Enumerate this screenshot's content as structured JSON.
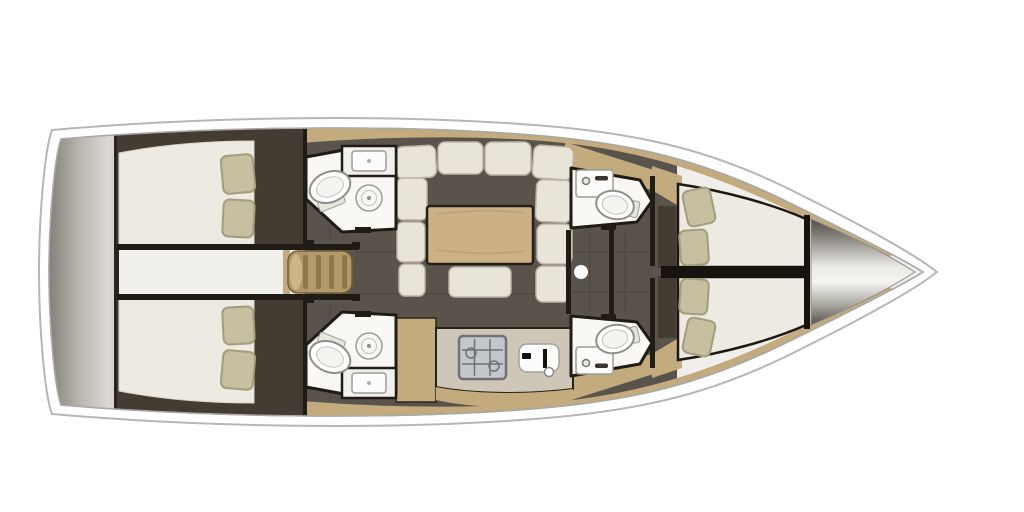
{
  "meta": {
    "title": "Sailing yacht interior layout — top-down floor plan",
    "view": "plan-view",
    "bow_direction": "right",
    "stern_direction": "left"
  },
  "colors": {
    "background": "#ffffff",
    "hull_outline": "#b7b6b4",
    "inner_outline": "#a8a8a6",
    "deck": "#efeeea",
    "floor": "#59534b",
    "cabinetry_dark": "#443c32",
    "wood_trim": "#c3ab7e",
    "wood_table": "#ccb187",
    "wood_steps": "#b49a6b",
    "step_slat": "#8d774f",
    "mattress": "#edebe1",
    "cushion": "#e8e5d8",
    "pillow": "#c6c0a0",
    "pillow_edge": "#a49d7d",
    "wall": "#201b15",
    "fixture_white": "#f9f8f5",
    "fixture_stroke": "#9c9c97",
    "counter": "#cec7b7",
    "stove_body": "#c3c7cb",
    "stove_grid": "#6f7378",
    "corridor": "#f1efe9",
    "transom_dark": "#827e77",
    "transom_light": "#dbd8d2",
    "bow_cone_dark": "#55524d",
    "bow_cone_light": "#f4f3f1"
  },
  "areas": {
    "swim_platform": {
      "label": "transom swim platform"
    },
    "aft_cabin_port": {
      "label": "aft double cabin port"
    },
    "aft_cabin_starboard": {
      "label": "aft double cabin starboard"
    },
    "aft_passage": {
      "label": "central passage between aft cabins"
    },
    "companionway": {
      "label": "companionway steps"
    },
    "head_port_aft": {
      "label": "port aft head with toilet, basin and shower console"
    },
    "head_starboard_aft": {
      "label": "starboard aft head with toilet, basin and shower console"
    },
    "saloon": {
      "label": "saloon with U-shaped sofa, table and ottoman"
    },
    "galley": {
      "label": "galley with stove and sink"
    },
    "head_port_forward": {
      "label": "port forward head with toilet and washbasin"
    },
    "head_starboard_forward": {
      "label": "starboard forward head with toilet and washbasin"
    },
    "forward_cabin": {
      "label": "forward cabin with twin V-berths"
    },
    "bow_locker": {
      "label": "bow anchor locker"
    }
  },
  "fixtures": [
    "toilet-icon",
    "washbasin-icon",
    "sink-icon",
    "stove-icon",
    "mast-post",
    "saloon-table",
    "ottoman",
    "pillow",
    "steps",
    "sofa-cushion"
  ]
}
